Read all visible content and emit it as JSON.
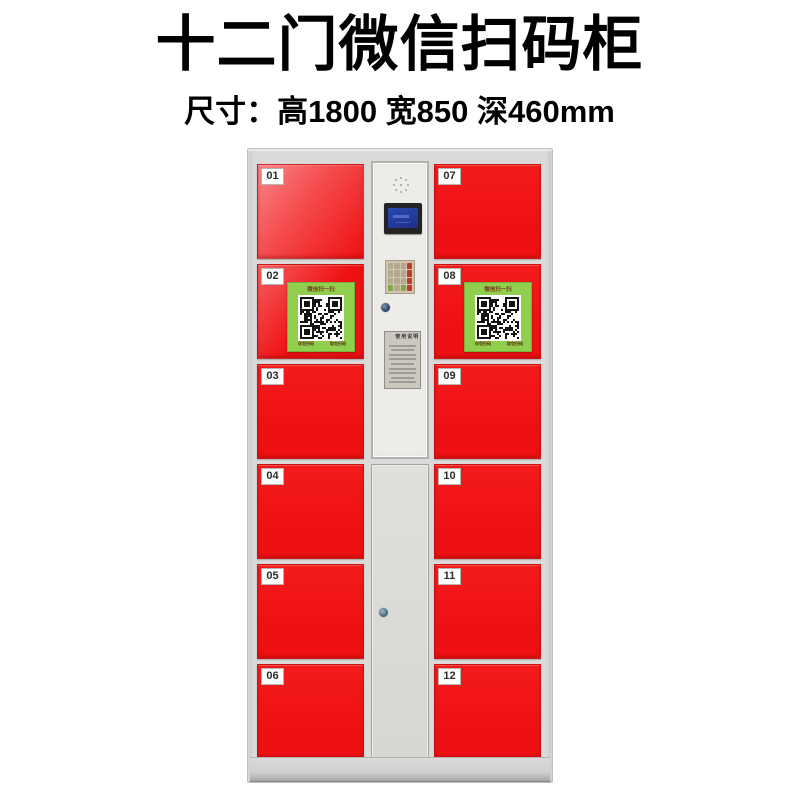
{
  "header": {
    "title": "十二门微信扫码柜",
    "subtitle": "尺寸：高1800 宽850 深460mm",
    "dimensions": {
      "height_mm": 1800,
      "width_mm": 850,
      "depth_mm": 460
    }
  },
  "cabinet": {
    "door_count": 12,
    "doors_left": [
      {
        "number": "01"
      },
      {
        "number": "02"
      },
      {
        "number": "03"
      },
      {
        "number": "04"
      },
      {
        "number": "05"
      },
      {
        "number": "06"
      }
    ],
    "doors_right": [
      {
        "number": "07"
      },
      {
        "number": "08"
      },
      {
        "number": "09"
      },
      {
        "number": "10"
      },
      {
        "number": "11"
      },
      {
        "number": "12"
      }
    ],
    "qr_sticker": {
      "top_label": "微信扫一扫",
      "bottom_left_label": "存包扫码",
      "bottom_right_label": "取包扫码"
    },
    "control_panel": {
      "speaker": "speaker-grille",
      "display": "lcd-display",
      "keypad": "numeric-keypad",
      "lock": "round-cam-lock",
      "instruction_label_title": "使用说明"
    },
    "colors": {
      "door_red": "#ee1012",
      "qr_green": "#90cf4d",
      "frame_gray": "#dbdad8",
      "panel_face": "#edece8"
    }
  }
}
